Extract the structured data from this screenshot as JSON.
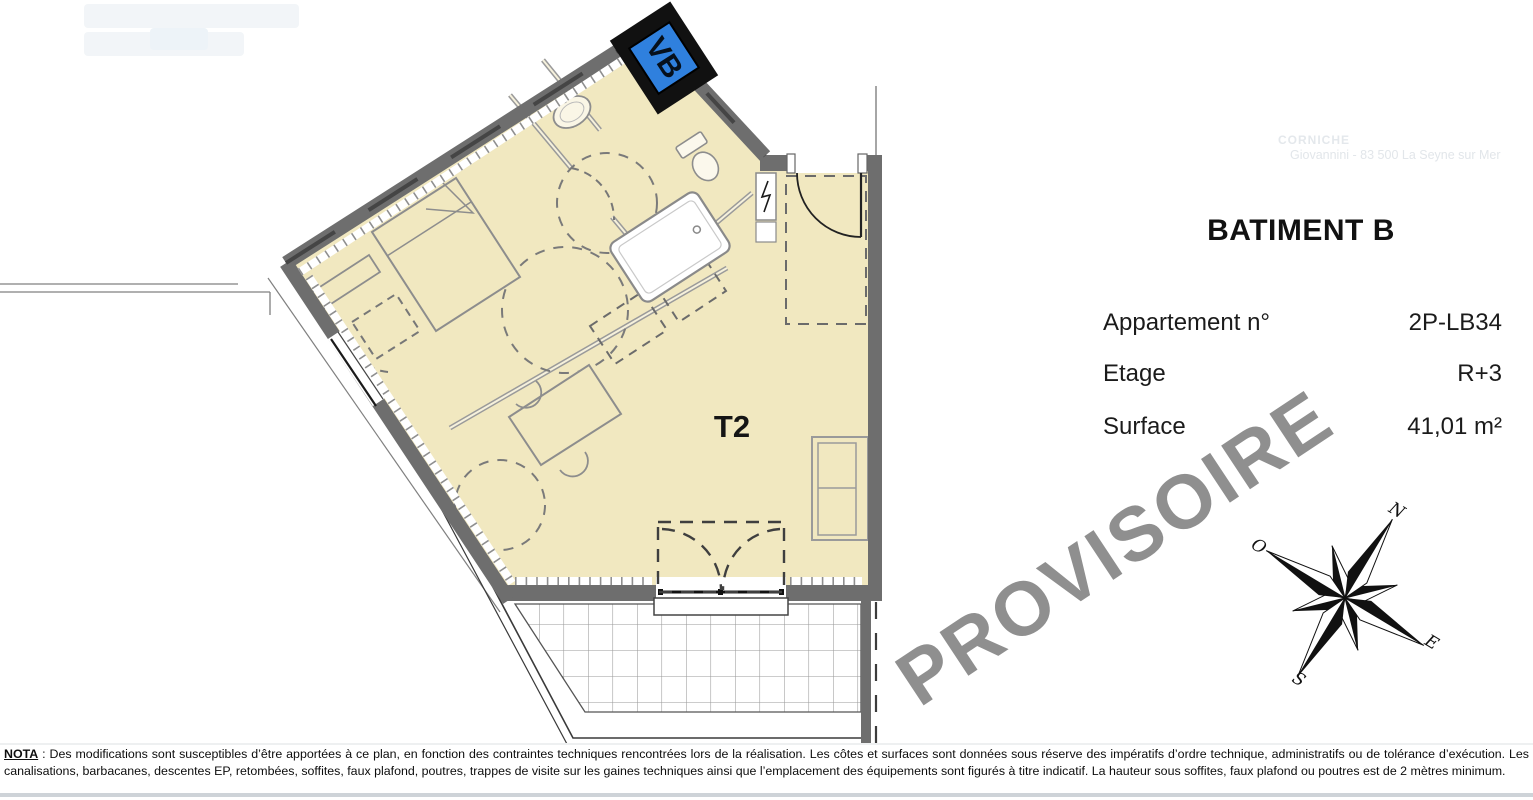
{
  "plan": {
    "unit_type": "T2",
    "vent_box_label": "VB",
    "room_fill": "#f1e8c0",
    "wall_color": "#6e6e6e",
    "vent_box_blue": "#2f80de"
  },
  "info_panel": {
    "title": "BATIMENT B",
    "rows": [
      {
        "label": "Appartement n°",
        "value": "2P-LB34"
      },
      {
        "label": "Etage",
        "value": "R+3"
      },
      {
        "label": "Surface",
        "value": "41,01 m²"
      }
    ]
  },
  "watermark": {
    "text": "PROVISOIRE",
    "color": "#8f8f8f"
  },
  "compass": {
    "north": "N",
    "west": "O",
    "east": "E",
    "south": "S"
  },
  "faint_header": {
    "line1": "CORNICHE",
    "line2": "Giovannini - 83 500 La Seyne sur Mer"
  },
  "nota": {
    "label": "NOTA",
    "body": " : Des modifications sont susceptibles d’être apportées à ce plan, en fonction des contraintes techniques rencontrées lors de la réalisation. Les côtes et surfaces sont données sous réserve des impératifs d’ordre technique, administratifs ou de tolérance d’exécution. Les canalisations, barbacanes, descentes EP, retombées, soffites, faux plafond, poutres, trappes de visite sur les gaines techniques ainsi que l’emplacement des équipements sont figurés à titre indicatif. La hauteur sous soffites, faux plafond ou poutres est de 2 mètres minimum."
  }
}
